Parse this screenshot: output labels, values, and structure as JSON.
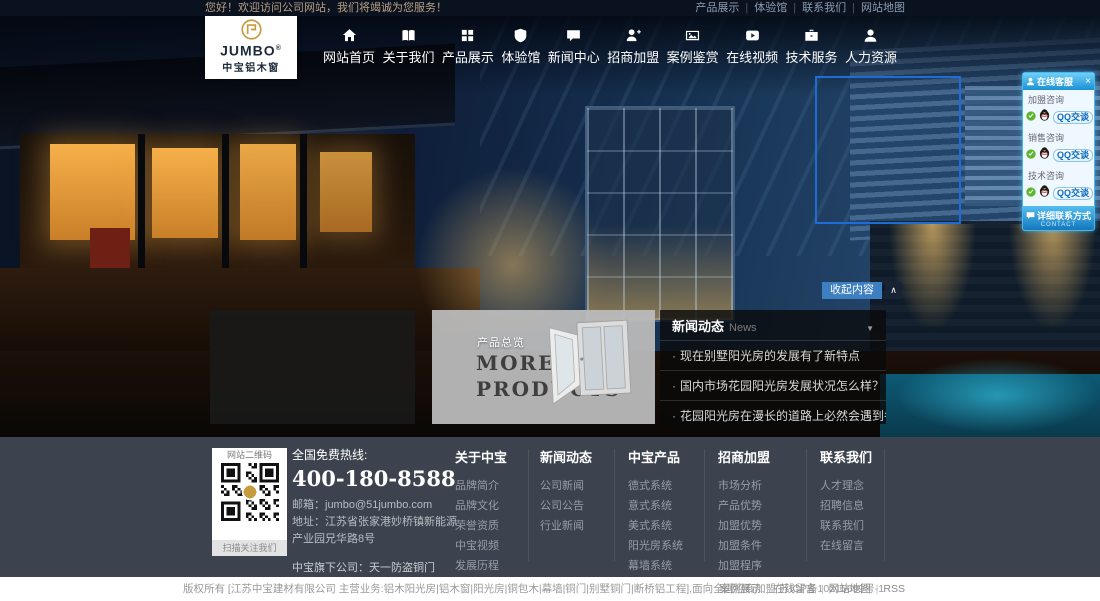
{
  "topbar": {
    "welcome": "您好！欢迎访问公司网站，我们将竭诚为您服务！",
    "links": [
      "产品展示",
      "体验馆",
      "联系我们",
      "网站地图"
    ]
  },
  "logo": {
    "name": "JUMBO",
    "reg": "®",
    "subtitle": "中宝铝木窗"
  },
  "nav": {
    "items": [
      {
        "label": "网站首页",
        "icon": "home-icon"
      },
      {
        "label": "关于我们",
        "icon": "book-icon"
      },
      {
        "label": "产品展示",
        "icon": "grid-icon"
      },
      {
        "label": "体验馆",
        "icon": "shield-icon"
      },
      {
        "label": "新闻中心",
        "icon": "chat-icon"
      },
      {
        "label": "招商加盟",
        "icon": "user-plus-icon"
      },
      {
        "label": "案例鉴赏",
        "icon": "photo-icon"
      },
      {
        "label": "在线视频",
        "icon": "video-icon"
      },
      {
        "label": "技术服务",
        "icon": "briefcase-icon"
      },
      {
        "label": "人力资源",
        "icon": "user-icon"
      }
    ]
  },
  "qq_panel": {
    "title": "在线客服",
    "close": "×",
    "groups": [
      {
        "label": "加盟咨询",
        "button": "QQ交谈"
      },
      {
        "label": "销售咨询",
        "button": "QQ交谈"
      },
      {
        "label": "技术咨询",
        "button": "QQ交谈"
      }
    ],
    "footer": "详细联系方式",
    "footer_sub": "CONTACT"
  },
  "hero": {
    "collapse_button": "收起内容",
    "collapse_arrow": "∧"
  },
  "products_panel": {
    "tag": "产品总览",
    "title_line1": "MORE",
    "title_line2": "PRODUCTS"
  },
  "news_panel": {
    "title": "新闻动态",
    "title_en": "News",
    "caret": "▼",
    "items": [
      "现在别墅阳光房的发展有了新特点",
      "国内市场花园阳光房发展状况怎么样？",
      "花园阳光房在漫长的道路上必然会遇到各种挑战"
    ]
  },
  "footer": {
    "qr": {
      "title": "网站二维码",
      "caption": "扫描关注我们"
    },
    "hotline_label": "全国免费热线:",
    "hotline": "400-180-8588",
    "email": "邮箱：jumbo@51jumbo.com",
    "address": "地址：江苏省张家港妙桥镇新能源产业园兄华路8号",
    "subsidiary": "中宝旗下公司：天一防盗铜门",
    "columns": [
      {
        "title": "关于中宝",
        "links": [
          "品牌简介",
          "品牌文化",
          "荣誉资质",
          "中宝视频",
          "发展历程",
          "品牌形象"
        ]
      },
      {
        "title": "新闻动态",
        "links": [
          "公司新闻",
          "公司公告",
          "行业新闻"
        ]
      },
      {
        "title": "中宝产品",
        "links": [
          "德式系统",
          "意式系统",
          "美式系统",
          "阳光房系统",
          "幕墙系统",
          "断桥铝系统"
        ]
      },
      {
        "title": "招商加盟",
        "links": [
          "市场分析",
          "产品优势",
          "加盟优势",
          "加盟条件",
          "加盟程序",
          "加盟留言",
          "申请表下载"
        ]
      },
      {
        "title": "联系我们",
        "links": [
          "人才理念",
          "招聘信息",
          "联系我们",
          "在线留言"
        ]
      }
    ]
  },
  "bottombar": {
    "copyright": "版权所有 [江苏中宝建材有限公司 主营业务:铝木阳光房|铝木窗|阳光房|铜包木|幕墙|铜门|别墅铜门|断桥铝工程],面向全国招商加盟 苏ICP备10215699号-1",
    "links": [
      "案例展示",
      "在线留言",
      "网站地图",
      "RSS"
    ]
  },
  "colors": {
    "accent_blue": "#1d6cd8",
    "qq_blue": "#1b90d4",
    "footer_bg": "#3d434e",
    "gold": "#c59b3d"
  }
}
